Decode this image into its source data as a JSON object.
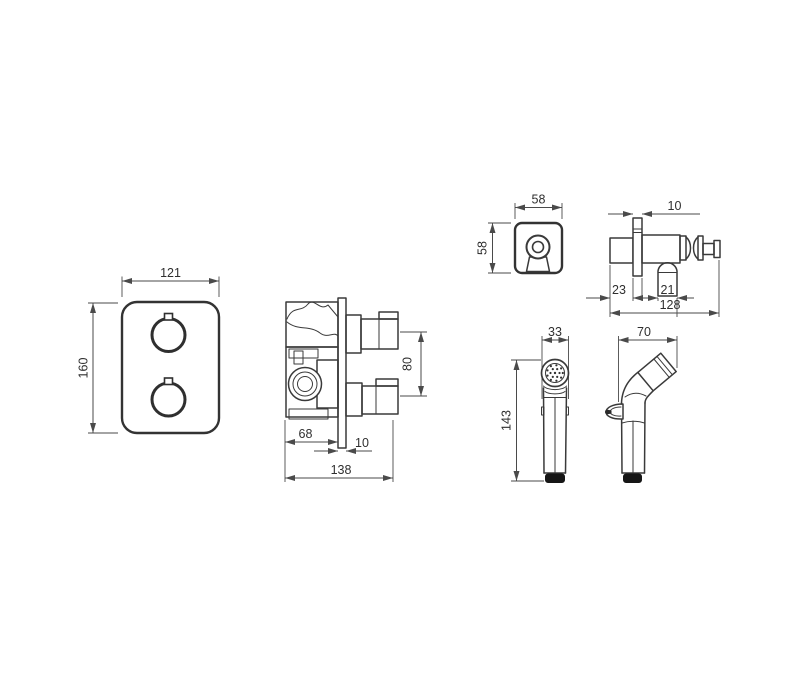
{
  "views": {
    "faceplate_front": {
      "width": "121",
      "height": "160"
    },
    "valve_body_side": {
      "depth_to_plate": "68",
      "plate_thickness": "10",
      "total_depth": "138",
      "port_spacing": "80"
    },
    "outlet_plate_front": {
      "width": "58",
      "height": "58"
    },
    "outlet_side": {
      "plate_thickness": "10",
      "rear_depth": "23",
      "outlet_offset": "21",
      "total_depth": "128"
    },
    "handspray_front": {
      "width": "33",
      "height": "143"
    },
    "handspray_side": {
      "depth": "70"
    }
  }
}
